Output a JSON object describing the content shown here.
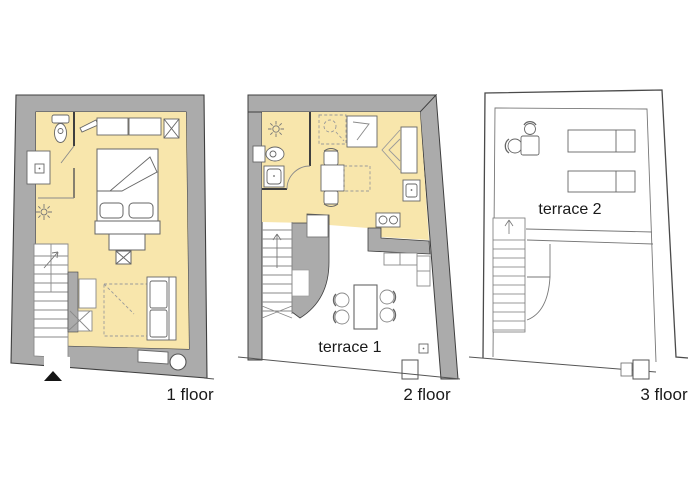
{
  "title": "apartment floor plans",
  "colors": {
    "wall_gray": "#ababab",
    "room_yellow": "#f8e6ac",
    "outline_dark": "#3f3f3f",
    "furniture_line": "#6f6f6f",
    "background": "#ffffff",
    "text": "#1a1a1a"
  },
  "floors": [
    {
      "label": "1 floor",
      "furniture_icons": [
        "toilet-icon",
        "sink-icon",
        "wall-lamp-icon",
        "wardrobe-icon",
        "chimney-icon",
        "double-bed-icon",
        "pillow-icon",
        "bench-icon",
        "stool-icon",
        "rug-dashed-icon",
        "sofa-icon",
        "stairs-icon",
        "entrance-arrow-icon",
        "radiator-icon",
        "column-circle-icon"
      ]
    },
    {
      "label": "2 floor",
      "terrace_label": "terrace 1",
      "furniture_icons": [
        "wall-lamp-icon",
        "toilet-icon",
        "sink-icon",
        "shower-icon",
        "cabinet-icon",
        "wardrobe-icon",
        "chair-icon",
        "table-icon",
        "folding-table-dashed-icon",
        "stove-icon",
        "kitchen-sink-icon",
        "stairs-icon",
        "dining-table-icon",
        "terrace-chair-icon",
        "bench-icon",
        "door-step-icon"
      ]
    },
    {
      "label": "3 floor",
      "terrace_label": "terrace 2",
      "furniture_icons": [
        "bistro-table-icon",
        "chair-icon",
        "sun-lounger-icon",
        "stairs-icon",
        "door-step-icon"
      ]
    }
  ]
}
